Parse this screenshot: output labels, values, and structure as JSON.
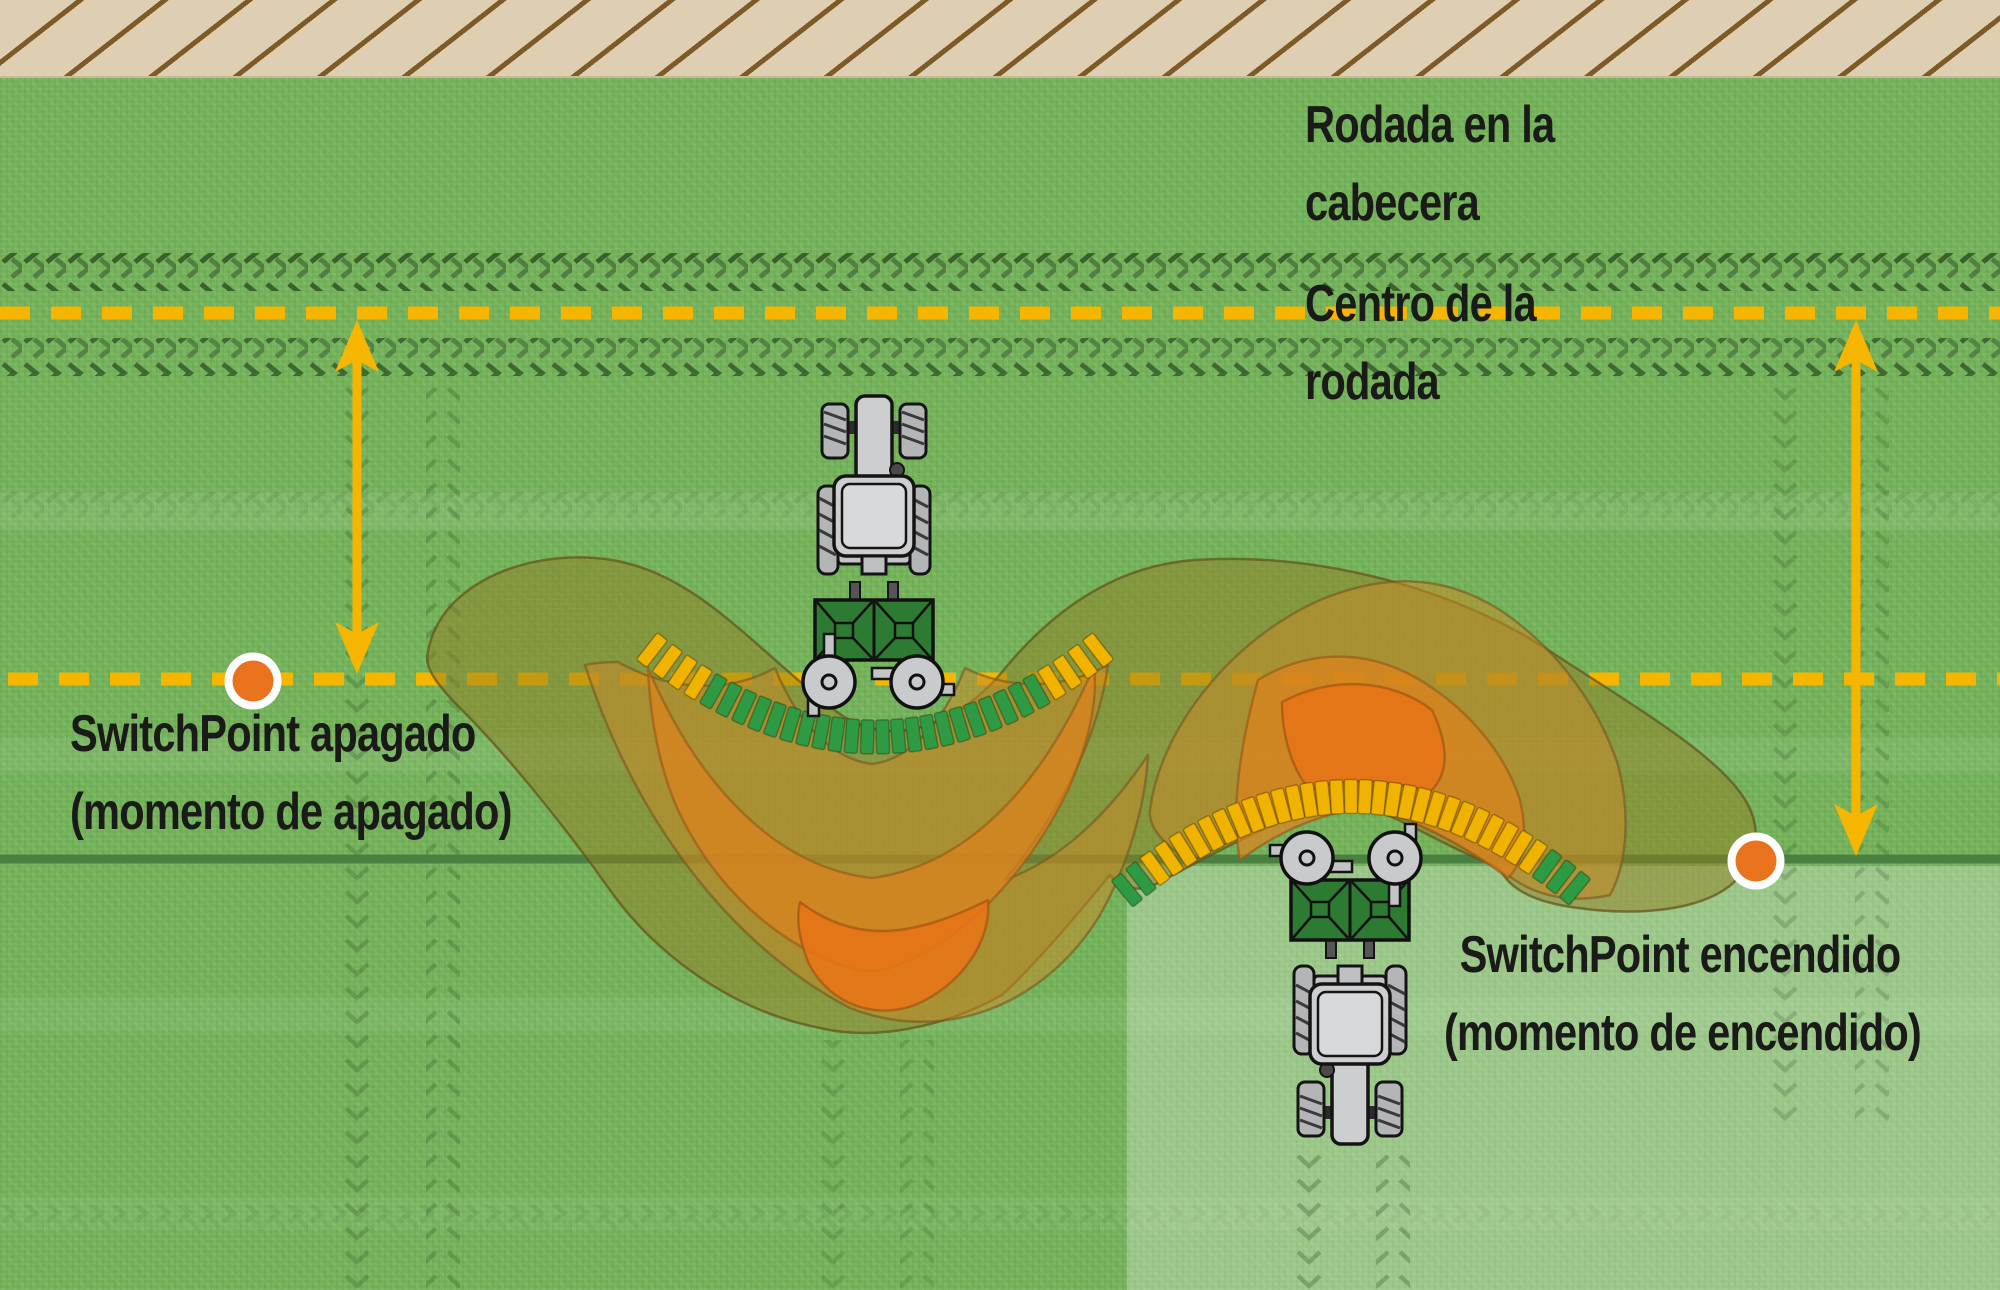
{
  "title": "SwitchPoint spreading diagram",
  "labels": {
    "headland_track": {
      "line1": "Rodada en la",
      "line2": "cabecera"
    },
    "track_center": {
      "line1": "Centro de la",
      "line2": "rodada"
    },
    "switchpoint_off": {
      "line1": "SwitchPoint apagado",
      "line2": "(momento de apagado)"
    },
    "switchpoint_on": {
      "line1": "SwitchPoint encendido",
      "line2": "(momento de encendido)"
    }
  },
  "colors": {
    "field_green": "#73b159",
    "field_light_overlay": "rgba(255,255,255,0.28)",
    "headland_sand": "#decfb2",
    "headland_hatch": "#7d5a28",
    "dashed_line_yellow": "#f6b600",
    "application_line_green": "#4a8040",
    "arrow_yellow": "#f6b600",
    "marker_orange": "#e8731c",
    "marker_ring": "#ffffff",
    "track_chevron": "#24421c",
    "bar_yellow": "#f0b400",
    "bar_green": "#2f9a44",
    "spread_outer": "rgba(146,126,34,0.50)",
    "spread_mid": "rgba(198,138,40,0.55)",
    "spread_inner": "rgba(222,130,28,0.70)",
    "spread_core": "rgba(232,116,22,0.88)",
    "tractor_body": "#cdced0",
    "implement_green": "#2d7a32",
    "text": "#1a1a18"
  },
  "icons": {
    "tractor_up": "tractor-with-spreader-moving-up",
    "tractor_down": "tractor-with-spreader-moving-down",
    "marker_off": "switchpoint-off-marker",
    "marker_on": "switchpoint-on-marker"
  },
  "decorations": {
    "spread_arcs": [
      {
        "p0": [
          652,
          650
        ],
        "p1": [
          875,
          824
        ],
        "p2": [
          1098,
          650
        ],
        "count": 30,
        "bar_w": 13,
        "bar_h": 34,
        "start_color": "#f0b400",
        "mid_color": "#2f9a44",
        "end_color": "#f0b400",
        "n_start": 4,
        "n_end": 4
      },
      {
        "p0": [
          1127,
          890
        ],
        "p1": [
          1351,
          704
        ],
        "p2": [
          1575,
          888
        ],
        "count": 33,
        "bar_w": 13,
        "bar_h": 34,
        "start_color": "#2f9a44",
        "mid_color": "#f0b400",
        "end_color": "#2f9a44",
        "n_start": 2,
        "n_end": 3
      }
    ]
  }
}
